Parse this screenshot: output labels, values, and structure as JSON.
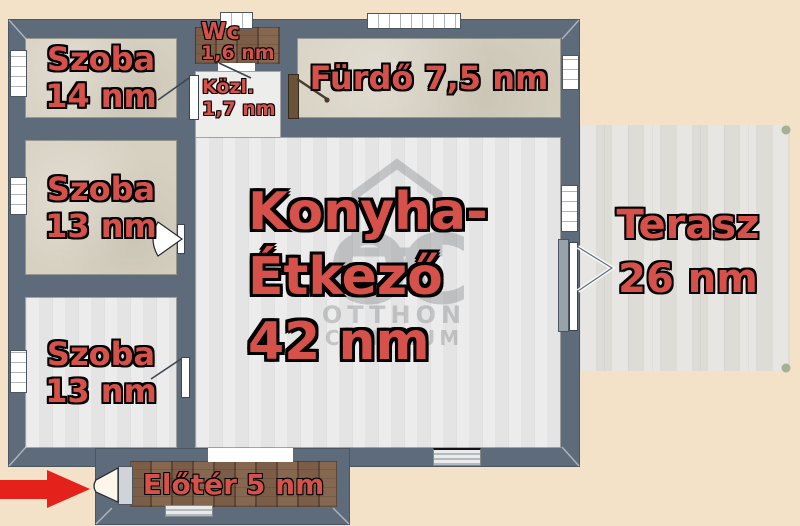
{
  "rooms": {
    "szoba14": {
      "name": "Szoba",
      "area": "14 nm"
    },
    "szoba13_middle": {
      "name": "Szoba",
      "area": "13 nm"
    },
    "szoba13_bottom": {
      "name": "Szoba",
      "area": "13 nm"
    },
    "wc": {
      "name": "Wc",
      "area": "1,6 nm"
    },
    "kozlekedo": {
      "name": "Közl.",
      "area": "1,7 nm"
    },
    "furdo": {
      "name": "Fürdő",
      "area": "7,5 nm"
    },
    "konyha_etkezo": {
      "name_line1": "Konyha-",
      "name_line2": "Étkező",
      "area": "42 nm"
    },
    "terasz": {
      "name": "Terasz",
      "area": "26 nm"
    },
    "eloter": {
      "name": "Előtér",
      "area": "5 nm"
    }
  },
  "watermark": {
    "logo": "OC",
    "line1": "OTTHON",
    "line2": "CENTRUM"
  },
  "colors": {
    "wall": "#5d6b7b",
    "background": "#f4e2c8",
    "room_label": "#d5514a",
    "entrance_arrow": "#e4211b"
  }
}
